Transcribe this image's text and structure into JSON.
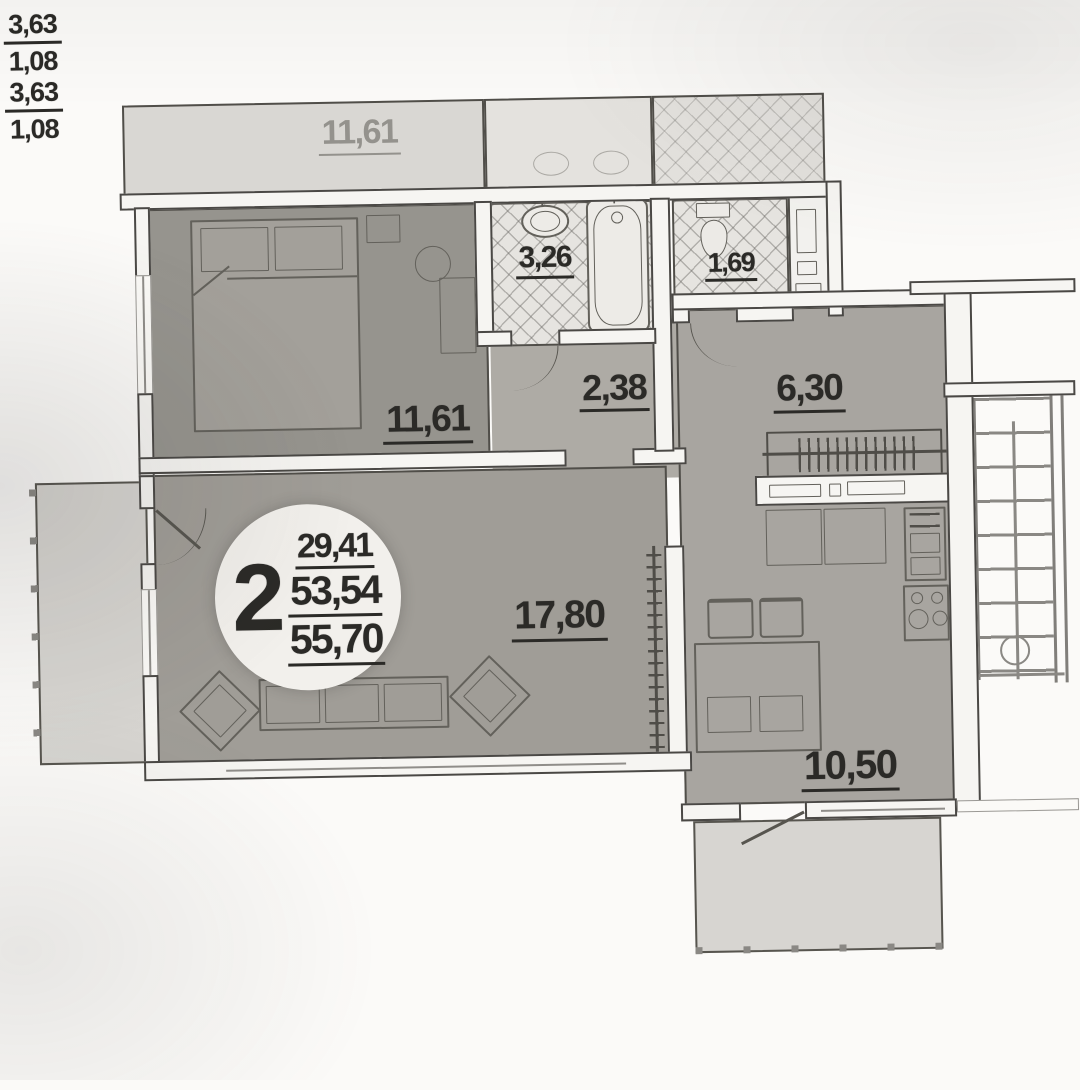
{
  "apartment": {
    "rooms_badge": "2",
    "living_area": "29,41",
    "area_no_balcony": "53,54",
    "total_area": "55,70"
  },
  "rooms": {
    "neighbor_room": {
      "area": "11,61"
    },
    "bedroom": {
      "area": "11,61"
    },
    "bathroom": {
      "area": "3,26"
    },
    "wc": {
      "area": "1,69"
    },
    "hallway": {
      "area": "2,38"
    },
    "entry": {
      "area": "6,30"
    },
    "living_room": {
      "area": "17,80"
    },
    "kitchen": {
      "area": "10,50"
    },
    "balcony_left": {
      "area": "3,63",
      "reduced_area": "1,08"
    },
    "balcony_bottom": {
      "area": "3,63",
      "reduced_area": "1,08"
    }
  }
}
